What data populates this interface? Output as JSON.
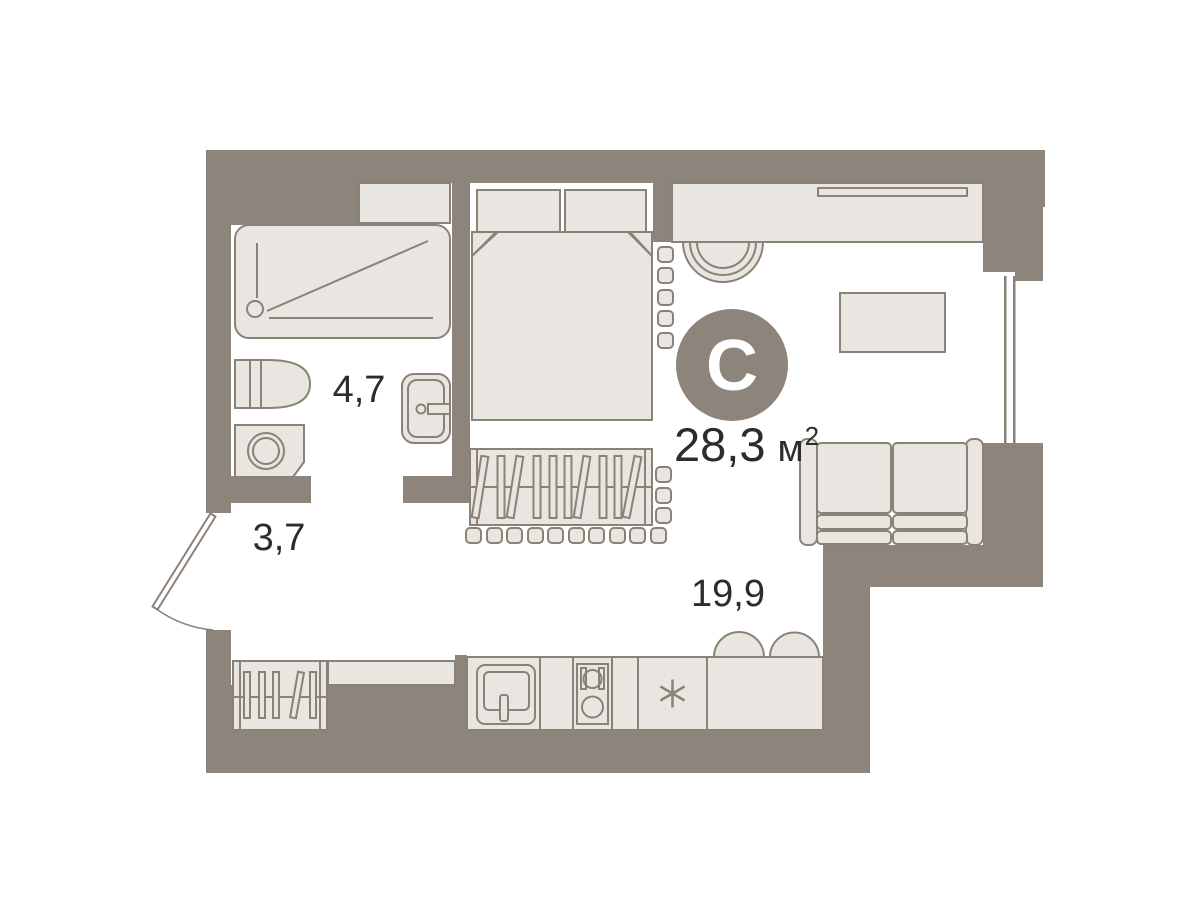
{
  "title": "Studio apartment floor plan",
  "badge": {
    "letter": "С"
  },
  "total_area": {
    "value": "28,3",
    "unit": "м",
    "sup": "2"
  },
  "rooms": {
    "bathroom": "4,7",
    "hallway": "3,7",
    "living": "19,9"
  },
  "colors": {
    "wall": "#8d857c",
    "furniture": "#e9e6e2",
    "line": "#8a8177",
    "text": "#2d2c2a",
    "white": "#ffffff",
    "badgetext": "#ffffff"
  }
}
